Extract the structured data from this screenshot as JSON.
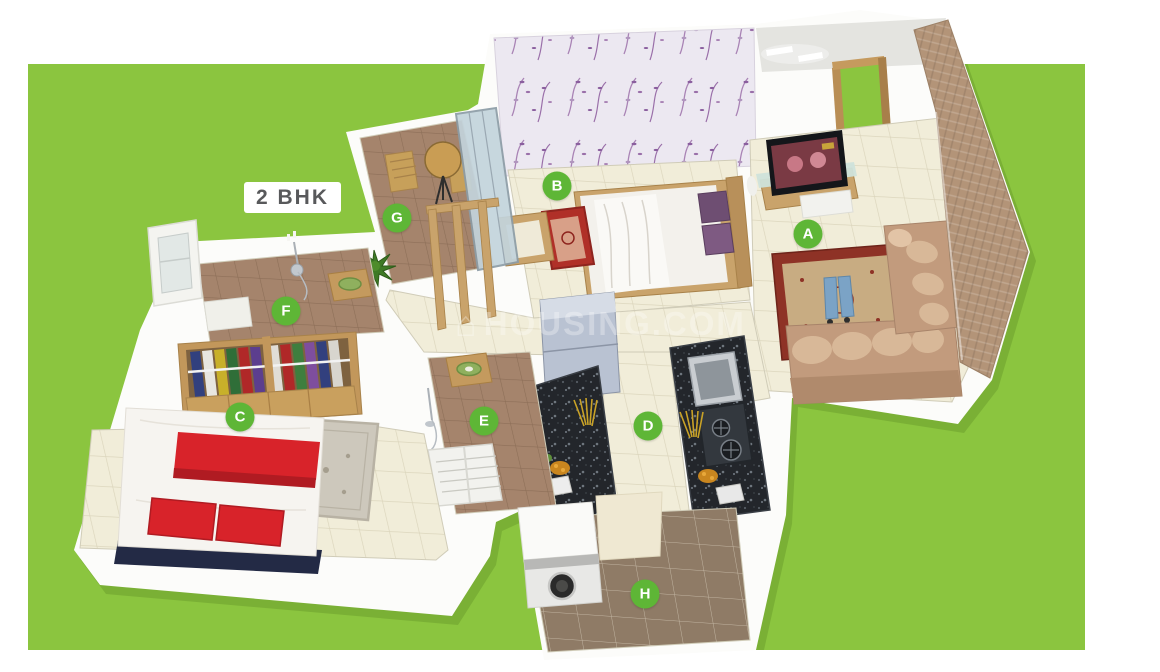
{
  "scene": {
    "plan_type_label": "2 BHK",
    "watermark_text": "HOUSING.COM"
  },
  "colors": {
    "panel_green": "#8BC53F",
    "badge_green": "#5EB636",
    "label_text": "#58595B"
  },
  "rooms": [
    {
      "label": "A",
      "x": 808,
      "y": 234
    },
    {
      "label": "B",
      "x": 557,
      "y": 186
    },
    {
      "label": "C",
      "x": 240,
      "y": 417
    },
    {
      "label": "D",
      "x": 648,
      "y": 426
    },
    {
      "label": "E",
      "x": 484,
      "y": 421
    },
    {
      "label": "F",
      "x": 286,
      "y": 311
    },
    {
      "label": "G",
      "x": 397,
      "y": 218
    },
    {
      "label": "H",
      "x": 645,
      "y": 594
    }
  ]
}
